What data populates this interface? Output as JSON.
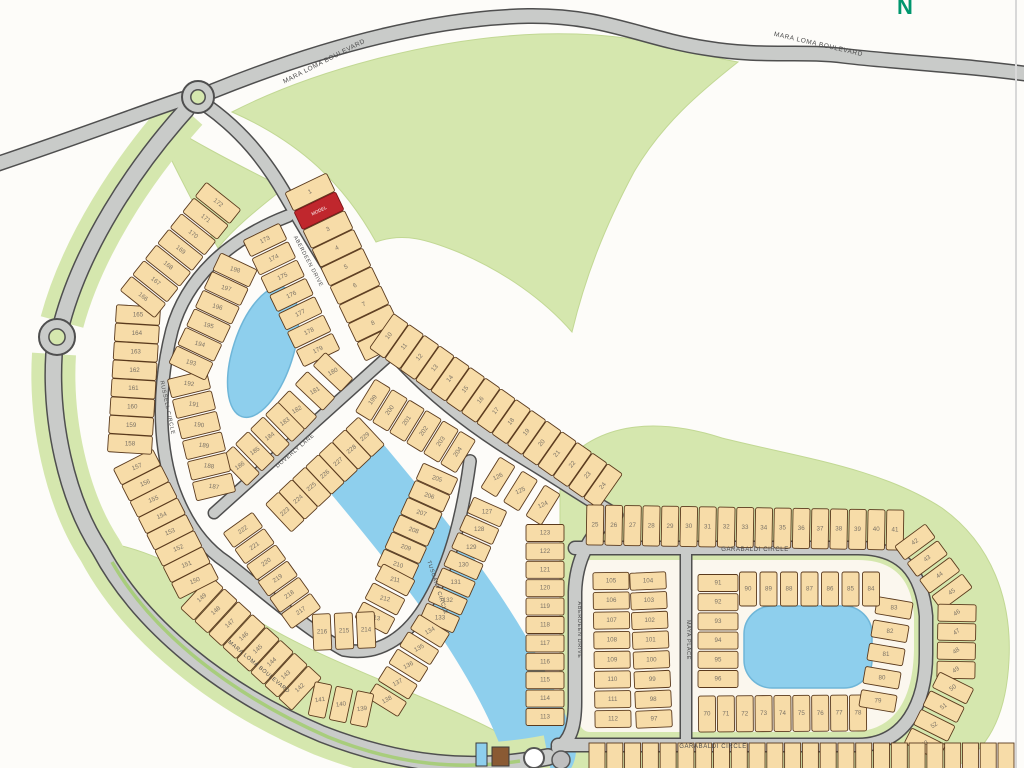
{
  "compass": {
    "letter": "N"
  },
  "colors": {
    "background": "#fdfcf9",
    "road": "#c9cbc9",
    "road_casing": "#4f4f4f",
    "green": "#d5e7ae",
    "green_median": "#a8cd7c",
    "water": "#8ecfed",
    "lot_fill": "#f7dca8",
    "lot_stroke": "#5a3a1d",
    "lot_number": "#7b7265",
    "model_red": "#c0272d",
    "plate": "#fbf7ee",
    "label": "#4b4b4b",
    "compass_green": "#00966e"
  },
  "street_labels": [
    {
      "text": "MARA LOMA BOULEVARD",
      "x": 325,
      "y": 63,
      "rot": -27,
      "size": 6.5
    },
    {
      "text": "MARA LOMA BOULEVARD",
      "x": 818,
      "y": 46,
      "rot": 13,
      "size": 6.5
    },
    {
      "text": "MARA LOMA BOULEVARD",
      "x": 258,
      "y": 668,
      "rot": 40,
      "size": 5.5
    },
    {
      "text": "RUSSELL CIRCLE",
      "x": 166,
      "y": 408,
      "rot": 78,
      "size": 5.5
    },
    {
      "text": "ABERDEEN DRIVE",
      "x": 307,
      "y": 262,
      "rot": 62,
      "size": 5.5
    },
    {
      "text": "DOVERLY LANE",
      "x": 296,
      "y": 452,
      "rot": -41,
      "size": 5.5
    },
    {
      "text": "TUSCANY CIRCLE",
      "x": 436,
      "y": 588,
      "rot": 72,
      "size": 5.5
    },
    {
      "text": "ABERDEEN DRIVE",
      "x": 578,
      "y": 630,
      "rot": 90,
      "size": 5.5
    },
    {
      "text": "MAYA PLACE",
      "x": 687,
      "y": 640,
      "rot": 90,
      "size": 5.5
    },
    {
      "text": "GARABALDI CIRCLE",
      "x": 755,
      "y": 551,
      "rot": 0,
      "size": 6
    },
    {
      "text": "GARABALDI CIRCLE",
      "x": 713,
      "y": 748,
      "rot": 0,
      "size": 6
    }
  ],
  "model_label": "MODEL",
  "lot_strips": [
    {
      "id": "lots-1-9",
      "nums": [
        "1",
        "MODEL",
        "3",
        "4",
        "5",
        "6",
        "7",
        "8",
        "9"
      ],
      "x1": 310,
      "y1": 192,
      "x2": 382,
      "y2": 342,
      "w": 20,
      "d": 46,
      "ta": -26
    },
    {
      "id": "lots-10-24",
      "nums": [
        "10",
        "11",
        "12",
        "13",
        "14",
        "15",
        "16",
        "17",
        "18",
        "19",
        "20",
        "21",
        "22",
        "23",
        "24"
      ],
      "x1": 389,
      "y1": 336,
      "x2": 603,
      "y2": 486,
      "w": 18,
      "d": 42,
      "ta": -50
    },
    {
      "id": "lots-173-179",
      "nums": [
        "173",
        "174",
        "175",
        "176",
        "177",
        "178",
        "179"
      ],
      "x1": 265,
      "y1": 240,
      "x2": 318,
      "y2": 350,
      "w": 18,
      "d": 40,
      "ta": -26
    },
    {
      "id": "lots-180-182",
      "nums": [
        "180",
        "181",
        "182"
      ],
      "x1": 333,
      "y1": 372,
      "x2": 297,
      "y2": 410,
      "w": 18,
      "d": 38,
      "ta": -30
    },
    {
      "id": "lots-183-186",
      "nums": [
        "183",
        "184",
        "185",
        "186"
      ],
      "x1": 285,
      "y1": 422,
      "x2": 240,
      "y2": 466,
      "w": 18,
      "d": 38,
      "ta": -35
    },
    {
      "id": "lots-187-192",
      "nums": [
        "187",
        "188",
        "189",
        "190",
        "191",
        "192"
      ],
      "x1": 214,
      "y1": 487,
      "x2": 189,
      "y2": 384,
      "w": 19,
      "d": 40,
      "ta": 8
    },
    {
      "id": "lots-193-198",
      "nums": [
        "193",
        "194",
        "195",
        "196",
        "197",
        "198"
      ],
      "x1": 191,
      "y1": 363,
      "x2": 235,
      "y2": 270,
      "w": 19,
      "d": 40,
      "ta": 15
    },
    {
      "id": "lots-142-149",
      "nums": [
        "142",
        "143",
        "144",
        "145",
        "146",
        "147",
        "148",
        "149"
      ],
      "x1": 300,
      "y1": 688,
      "x2": 202,
      "y2": 598,
      "w": 18,
      "d": 44,
      "ta": -42
    },
    {
      "id": "lots-150-157",
      "nums": [
        "150",
        "151",
        "152",
        "153",
        "154",
        "155",
        "156",
        "157"
      ],
      "x1": 195,
      "y1": 581,
      "x2": 137,
      "y2": 467,
      "w": 18,
      "d": 44,
      "ta": -22
    },
    {
      "id": "lots-158-165",
      "nums": [
        "158",
        "159",
        "160",
        "161",
        "162",
        "163",
        "164",
        "165"
      ],
      "x1": 130,
      "y1": 444,
      "x2": 138,
      "y2": 315,
      "w": 18,
      "d": 44,
      "ta": 0
    },
    {
      "id": "lots-166-172",
      "nums": [
        "166",
        "167",
        "168",
        "169",
        "170",
        "171",
        "172"
      ],
      "x1": 143,
      "y1": 297,
      "x2": 218,
      "y2": 203,
      "w": 18,
      "d": 44,
      "ta": 38
    },
    {
      "id": "lots-199-204",
      "nums": [
        "199",
        "200",
        "201",
        "202",
        "203",
        "204"
      ],
      "x1": 373,
      "y1": 400,
      "x2": 458,
      "y2": 452,
      "w": 18,
      "d": 38,
      "ta": -55
    },
    {
      "id": "lots-205-210",
      "nums": [
        "205",
        "206",
        "207",
        "208",
        "209",
        "210"
      ],
      "x1": 437,
      "y1": 479,
      "x2": 398,
      "y2": 565,
      "w": 18,
      "d": 38,
      "ta": 18
    },
    {
      "id": "lots-211-213",
      "nums": [
        "211",
        "212",
        "213"
      ],
      "x1": 395,
      "y1": 580,
      "x2": 375,
      "y2": 618,
      "w": 18,
      "d": 36,
      "ta": 12
    },
    {
      "id": "lots-214-216",
      "nums": [
        "214",
        "215",
        "216"
      ],
      "x1": 366,
      "y1": 630,
      "x2": 322,
      "y2": 632,
      "w": 18,
      "d": 36,
      "ta": 0
    },
    {
      "id": "lots-217-222",
      "nums": [
        "217",
        "218",
        "219",
        "220",
        "221",
        "222"
      ],
      "x1": 301,
      "y1": 611,
      "x2": 243,
      "y2": 530,
      "w": 18,
      "d": 36,
      "ta": -35
    },
    {
      "id": "lots-223-229",
      "nums": [
        "223",
        "224",
        "225",
        "226",
        "227",
        "228",
        "229"
      ],
      "x1": 285,
      "y1": 512,
      "x2": 365,
      "y2": 437,
      "w": 18,
      "d": 38,
      "ta": -40
    },
    {
      "id": "lots-124-126",
      "nums": [
        "124",
        "125",
        "126"
      ],
      "x1": 543,
      "y1": 505,
      "x2": 498,
      "y2": 477,
      "w": 18,
      "d": 36,
      "ta": -25
    },
    {
      "id": "lots-113-123",
      "nums": [
        "123",
        "122",
        "121",
        "120",
        "119",
        "118",
        "117",
        "116",
        "115",
        "114",
        "113"
      ],
      "x1": 545,
      "y1": 533,
      "x2": 545,
      "y2": 717,
      "w": 17,
      "d": 38,
      "ta": 0
    },
    {
      "id": "lots-127-133",
      "nums": [
        "127",
        "128",
        "129",
        "130",
        "131",
        "132",
        "133"
      ],
      "x1": 487,
      "y1": 512,
      "x2": 440,
      "y2": 618,
      "w": 17,
      "d": 36,
      "ta": 0
    },
    {
      "id": "lots-134-138",
      "nums": [
        "134",
        "135",
        "136",
        "137",
        "138"
      ],
      "x1": 430,
      "y1": 631,
      "x2": 387,
      "y2": 700,
      "w": 17,
      "d": 36,
      "ta": -28
    },
    {
      "id": "lots-139-141",
      "nums": [
        "139",
        "140",
        "141"
      ],
      "x1": 362,
      "y1": 709,
      "x2": 320,
      "y2": 700,
      "w": 17,
      "d": 34,
      "ta": -8
    },
    {
      "id": "lots-25-41",
      "nums": [
        "25",
        "26",
        "27",
        "28",
        "29",
        "30",
        "31",
        "32",
        "33",
        "34",
        "35",
        "36",
        "37",
        "38",
        "39",
        "40",
        "41"
      ],
      "x1": 595,
      "y1": 525,
      "x2": 895,
      "y2": 530,
      "w": 17,
      "d": 40,
      "ta": 0
    },
    {
      "id": "lots-42-45",
      "nums": [
        "42",
        "43",
        "44",
        "45"
      ],
      "x1": 915,
      "y1": 542,
      "x2": 952,
      "y2": 592,
      "w": 17,
      "d": 38,
      "ta": -35
    },
    {
      "id": "lots-46-49",
      "nums": [
        "46",
        "47",
        "48",
        "49"
      ],
      "x1": 957,
      "y1": 613,
      "x2": 956,
      "y2": 670,
      "w": 17,
      "d": 38,
      "ta": -35
    },
    {
      "id": "lots-50-53",
      "nums": [
        "50",
        "51",
        "52",
        "53"
      ],
      "x1": 953,
      "y1": 688,
      "x2": 925,
      "y2": 744,
      "w": 17,
      "d": 38,
      "ta": -35
    },
    {
      "id": "lots-70-78",
      "nums": [
        "70",
        "71",
        "72",
        "73",
        "74",
        "75",
        "76",
        "77",
        "78"
      ],
      "x1": 707,
      "y1": 714,
      "x2": 858,
      "y2": 713,
      "w": 17,
      "d": 36,
      "ta": 0
    },
    {
      "id": "lots-79-83",
      "nums": [
        "79",
        "80",
        "81",
        "82",
        "83"
      ],
      "x1": 878,
      "y1": 701,
      "x2": 894,
      "y2": 608,
      "w": 17,
      "d": 36,
      "ta": 0
    },
    {
      "id": "lots-84-90",
      "nums": [
        "90",
        "89",
        "88",
        "87",
        "86",
        "85",
        "84"
      ],
      "x1": 748,
      "y1": 589,
      "x2": 871,
      "y2": 589,
      "w": 17,
      "d": 34,
      "ta": 0
    },
    {
      "id": "lots-91-96",
      "nums": [
        "91",
        "92",
        "93",
        "94",
        "95",
        "96"
      ],
      "x1": 718,
      "y1": 583,
      "x2": 718,
      "y2": 679,
      "w": 17,
      "d": 40,
      "ta": 0
    },
    {
      "id": "lots-105-112",
      "nums": [
        "105",
        "106",
        "107",
        "108",
        "109",
        "110",
        "111",
        "112"
      ],
      "x1": 611,
      "y1": 581,
      "x2": 613,
      "y2": 719,
      "w": 17,
      "d": 36,
      "ta": 0
    },
    {
      "id": "lots-97-104",
      "nums": [
        "104",
        "103",
        "102",
        "101",
        "100",
        "99",
        "98",
        "97"
      ],
      "x1": 648,
      "y1": 581,
      "x2": 654,
      "y2": 719,
      "w": 17,
      "d": 36,
      "ta": 0
    }
  ],
  "bottom_row": {
    "x1": 597,
    "y1": 757,
    "x2": 1006,
    "y2": 757,
    "count": 24,
    "w": 16,
    "d": 28
  },
  "amenity": {
    "pool": {
      "x": 476,
      "y": 743,
      "w": 11,
      "h": 23
    },
    "building": {
      "x": 492,
      "y": 747,
      "w": 17,
      "h": 19
    },
    "spa_circle": {
      "cx": 534,
      "cy": 758,
      "r": 10
    },
    "feature_circle": {
      "cx": 561,
      "cy": 760,
      "r": 9
    }
  }
}
